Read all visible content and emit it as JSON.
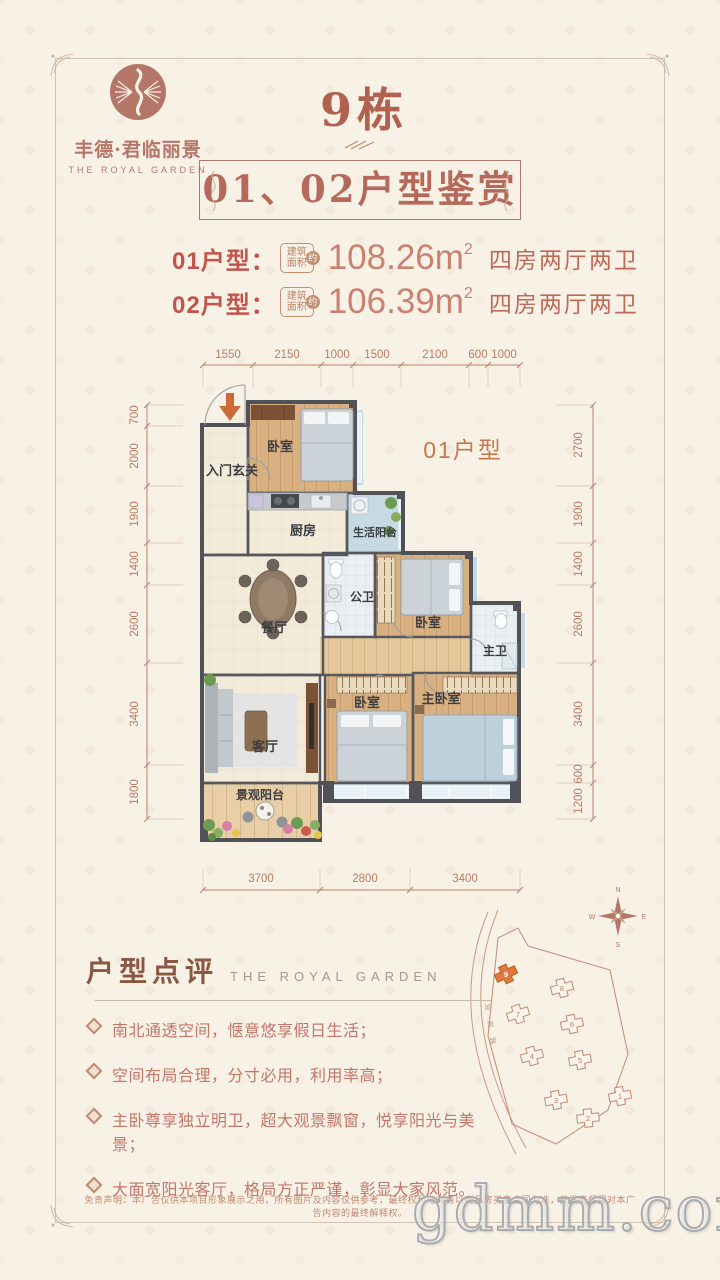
{
  "brand": {
    "logo_cn": "丰德·君临丽景",
    "logo_en": "THE ROYAL GARDEN"
  },
  "header": {
    "building": "9栋",
    "title": "01、02户型鉴赏"
  },
  "specs": [
    {
      "label": "01户型：",
      "badge_top": "建筑",
      "badge_bottom": "面积",
      "badge_mark": "约",
      "area": "108.26m",
      "area_sup": "2",
      "rooms": "四房两厅两卫"
    },
    {
      "label": "02户型：",
      "badge_top": "建筑",
      "badge_bottom": "面积",
      "badge_mark": "约",
      "area": "106.39m",
      "area_sup": "2",
      "rooms": "四房两厅两卫"
    }
  ],
  "floorplan": {
    "unit_label": "01户型",
    "rooms": {
      "hall": "入门玄关",
      "bedroom_top": "卧室",
      "kitchen": "厨房",
      "service_balcony": "生活阳台",
      "guest_bath": "公卫",
      "dining": "餐厅",
      "bedroom_mid": "卧室",
      "master_bath": "主卫",
      "living": "客厅",
      "bedroom_bottom": "卧室",
      "master_bedroom": "主卧室",
      "view_balcony": "景观阳台"
    },
    "dims_top": [
      "1550",
      "2150",
      "1000",
      "1500",
      "2100",
      "600",
      "1000"
    ],
    "dims_left": [
      "700",
      "2000",
      "1900",
      "1400",
      "2600",
      "3400",
      "1800"
    ],
    "dims_right": [
      "2700",
      "1900",
      "1400",
      "2600",
      "3400",
      "600",
      "1200"
    ],
    "dims_bottom": [
      "3700",
      "2800",
      "3400"
    ]
  },
  "review": {
    "title": "户型点评",
    "subtitle": "THE ROYAL GARDEN",
    "points": [
      "南北通透空间，惬意悠享假日生活；",
      "空间布局合理，分寸必用，利用率高；",
      "主卧尊享独立明卫，超大观景飘窗，悦享阳光与美景；",
      "大面宽阳光客厅，格局方正严谨，彰显大家风范。"
    ]
  },
  "sitemap": {
    "compass_n": "N",
    "compass_e": "E",
    "compass_s": "S",
    "compass_w": "W",
    "road": "迎宾路",
    "buildings": [
      "9",
      "8",
      "7",
      "6",
      "5",
      "4",
      "3",
      "2",
      "1"
    ]
  },
  "footer": {
    "disclaimer": "免责声明：本广告仅供本项目形象展示之用，所有图片及内容仅供参考，最终权利与义务以商品房买卖合同为准，开发商保留对本广告内容的最终解释权。",
    "watermark": "gdmm.com"
  },
  "colors": {
    "accent": "#b5695a",
    "label_red": "#c2554b",
    "wall": "#56575d",
    "highlight_building": "#e0793c"
  }
}
